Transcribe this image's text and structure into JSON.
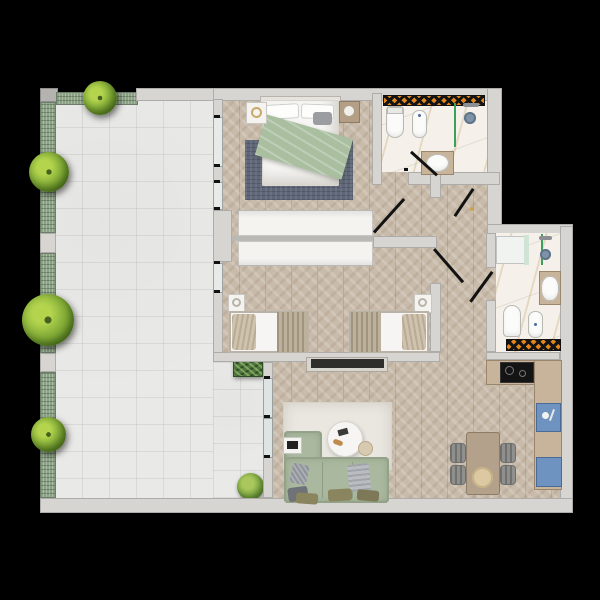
{
  "scene": {
    "type": "apartment floor plan",
    "style": "photorealistic top-down 3D render on black background",
    "visible_text": "none"
  },
  "palette": {
    "background": "#000000",
    "wall": "#d7d5d1",
    "wall_shadow": "#aeaca8",
    "terrace_tile": "#e9e9e7",
    "planter_green": "#8aa084",
    "tree_green": "#8db53c",
    "wood_floor": "#c9bbaa",
    "marble": "#f5f1ea",
    "radiator_orange": "#e2861c",
    "sofa_green": "#a9b89e",
    "master_rug": "#5e6678",
    "cabinet_blue": "#6f93c0",
    "counter_wood": "#c8b49a",
    "blanket_sage": "#a9bfa0",
    "door_line": "#121212"
  },
  "terrace": {
    "label": "Terrace",
    "floor": "white ceramic tile grid",
    "planter_strips": 4,
    "trees": [
      {
        "x": 100,
        "y": 98
      },
      {
        "x": 49,
        "y": 172
      },
      {
        "x": 48,
        "y": 320
      },
      {
        "x": 48,
        "y": 434
      }
    ],
    "bushes": [
      {
        "x": 248,
        "y": 368,
        "type": "planter box"
      },
      {
        "x": 250,
        "y": 487,
        "type": "round bush"
      }
    ]
  },
  "rooms": {
    "master_bedroom": {
      "label": "Master Bedroom",
      "furniture": [
        "double bed",
        "sage green throw blanket",
        "two white pillows",
        "grey cushion",
        "white nightstand",
        "wood nightstand",
        "blue-grey area rug",
        "built-in wardrobe",
        "two terrace windows"
      ]
    },
    "kids_bedroom": {
      "label": "Second Bedroom",
      "furniture": [
        "single bed left",
        "single bed right",
        "two white nightstands",
        "built-in wardrobe",
        "terrace window",
        "wall TV console"
      ]
    },
    "bathroom_top": {
      "label": "Bathroom 1",
      "fixtures": [
        "toilet",
        "bidet",
        "walk-in shower with green glass",
        "wood vanity with sink",
        "orange checkered radiator"
      ]
    },
    "bathroom_right": {
      "label": "Bathroom 2",
      "fixtures": [
        "walk-in shower with green glass",
        "wood vanity with sink",
        "toilet",
        "bidet",
        "orange checkered radiator"
      ]
    },
    "hallway": {
      "label": "Hallway",
      "doors": [
        "entrance door",
        "master bedroom door",
        "second bedroom door",
        "bathroom 1 door",
        "bathroom 2 door"
      ]
    },
    "living_room": {
      "label": "Living Room",
      "furniture": [
        "L-shaped sage green sofa",
        "assorted cushions",
        "cream rug",
        "round white coffee table",
        "beige side pouf",
        "white serving tray",
        "TV console",
        "sliding glass terrace door"
      ]
    },
    "kitchen_dining": {
      "label": "Kitchen / Dining",
      "furniture": [
        "L-shaped wood counter",
        "black cooktop",
        "blue sink unit",
        "blue appliance front",
        "wood dining table",
        "round platter",
        "four grey chairs",
        "orange checkered radiator"
      ]
    }
  }
}
